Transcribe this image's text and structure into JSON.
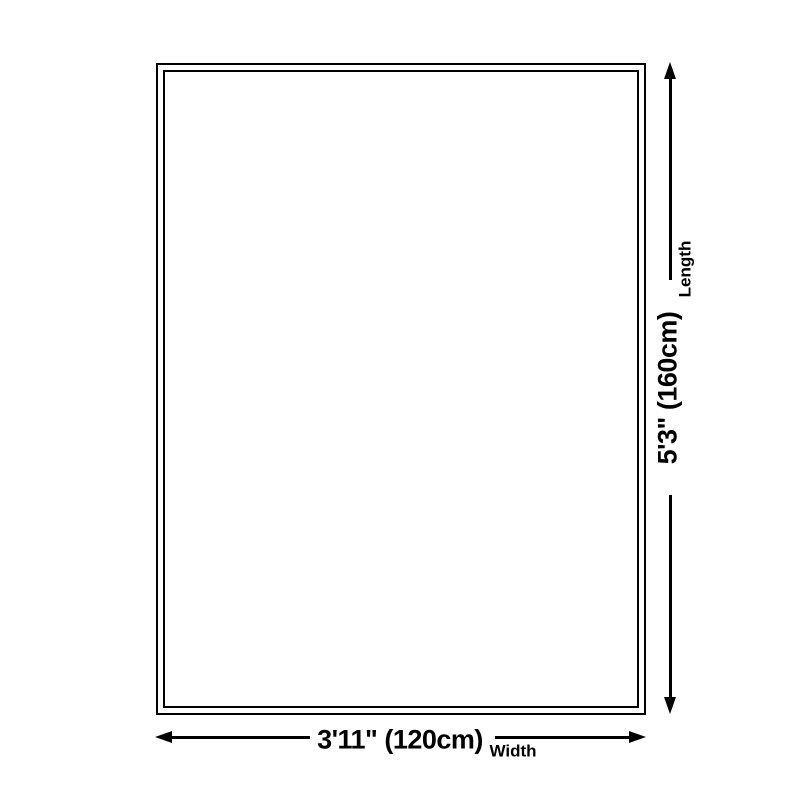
{
  "diagram": {
    "type": "product-dimension-diagram",
    "shape": "rectangle",
    "length": {
      "label": "Length",
      "value": "5'3\" (160cm)"
    },
    "width": {
      "label": "Width",
      "value": "3'11\" (120cm)"
    },
    "colors": {
      "line": "#000000",
      "text": "#000000",
      "background": "#ffffff"
    }
  }
}
